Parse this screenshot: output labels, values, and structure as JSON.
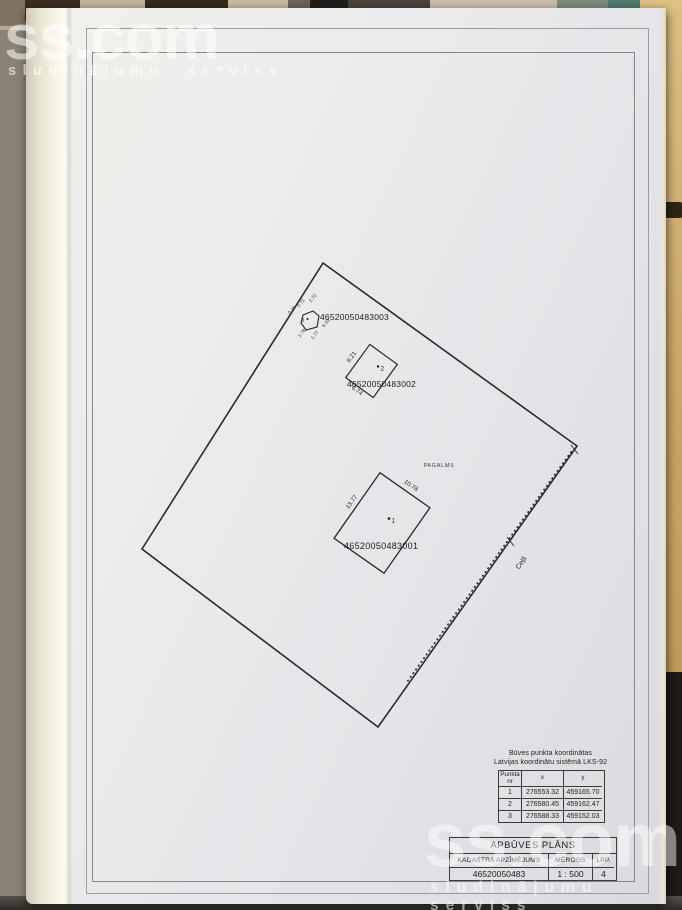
{
  "watermark": {
    "brand": "ss.com",
    "tagline": "sludinājumu serviss"
  },
  "plan": {
    "yard_label": "PAGALMS",
    "road_label": "Ceļš",
    "building1": {
      "marker": "1",
      "cadastre": "46520050483001",
      "dim_left": "13.77",
      "dim_right": "10.78"
    },
    "building2": {
      "marker": "2",
      "cadastre": "46520050483002",
      "dim_left": "8.21",
      "dim_bottom": "6.74"
    },
    "building3": {
      "marker": "3",
      "cadastre": "46520050483003",
      "dims": [
        "0.16",
        "2.72",
        "2.72",
        "6.03",
        "1.77",
        "1.78"
      ]
    }
  },
  "coordinates_table": {
    "title_line1": "Būves punkta koordinātas",
    "title_line2": "Latvijas koordinātu sistēmā LKS-92",
    "headers": {
      "nr_line1": "Punkta",
      "nr_line2": "nr",
      "x": "x",
      "y": "y"
    },
    "rows": [
      {
        "nr": "1",
        "x": "276553.32",
        "y": "459165.70"
      },
      {
        "nr": "2",
        "x": "276580.45",
        "y": "459162.47"
      },
      {
        "nr": "3",
        "x": "276588.33",
        "y": "459152.03"
      }
    ]
  },
  "title_block": {
    "title": "APBŪVES PLĀNS",
    "cadastre_label": "KADASTRA APZĪMĒJUMS",
    "scale_label": "MĒROGS",
    "page_label": "LPP.",
    "cadastre_value": "46520050483",
    "scale_value": "1 : 500",
    "page_value": "4"
  }
}
